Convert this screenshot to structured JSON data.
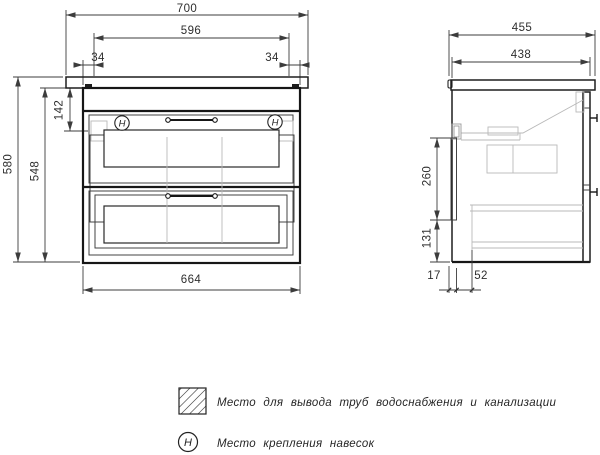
{
  "front_view": {
    "width_top": "700",
    "width_inner": "596",
    "offset_left": "34",
    "offset_right": "34",
    "height_total": "580",
    "height_body": "548",
    "height_top_section": "142",
    "width_body": "664",
    "hook_symbol": "H"
  },
  "side_view": {
    "depth_total": "455",
    "depth_body": "438",
    "pipe_zone_height": "260",
    "pipe_zone_bottom_offset": "131",
    "back_panel_inset": "17",
    "pipe_offset": "52"
  },
  "legend": {
    "hook_symbol": "H",
    "pipe_zone_label": "Место для вывода труб водоснабжения и канализации",
    "hook_label": "Место крепления навесок"
  }
}
